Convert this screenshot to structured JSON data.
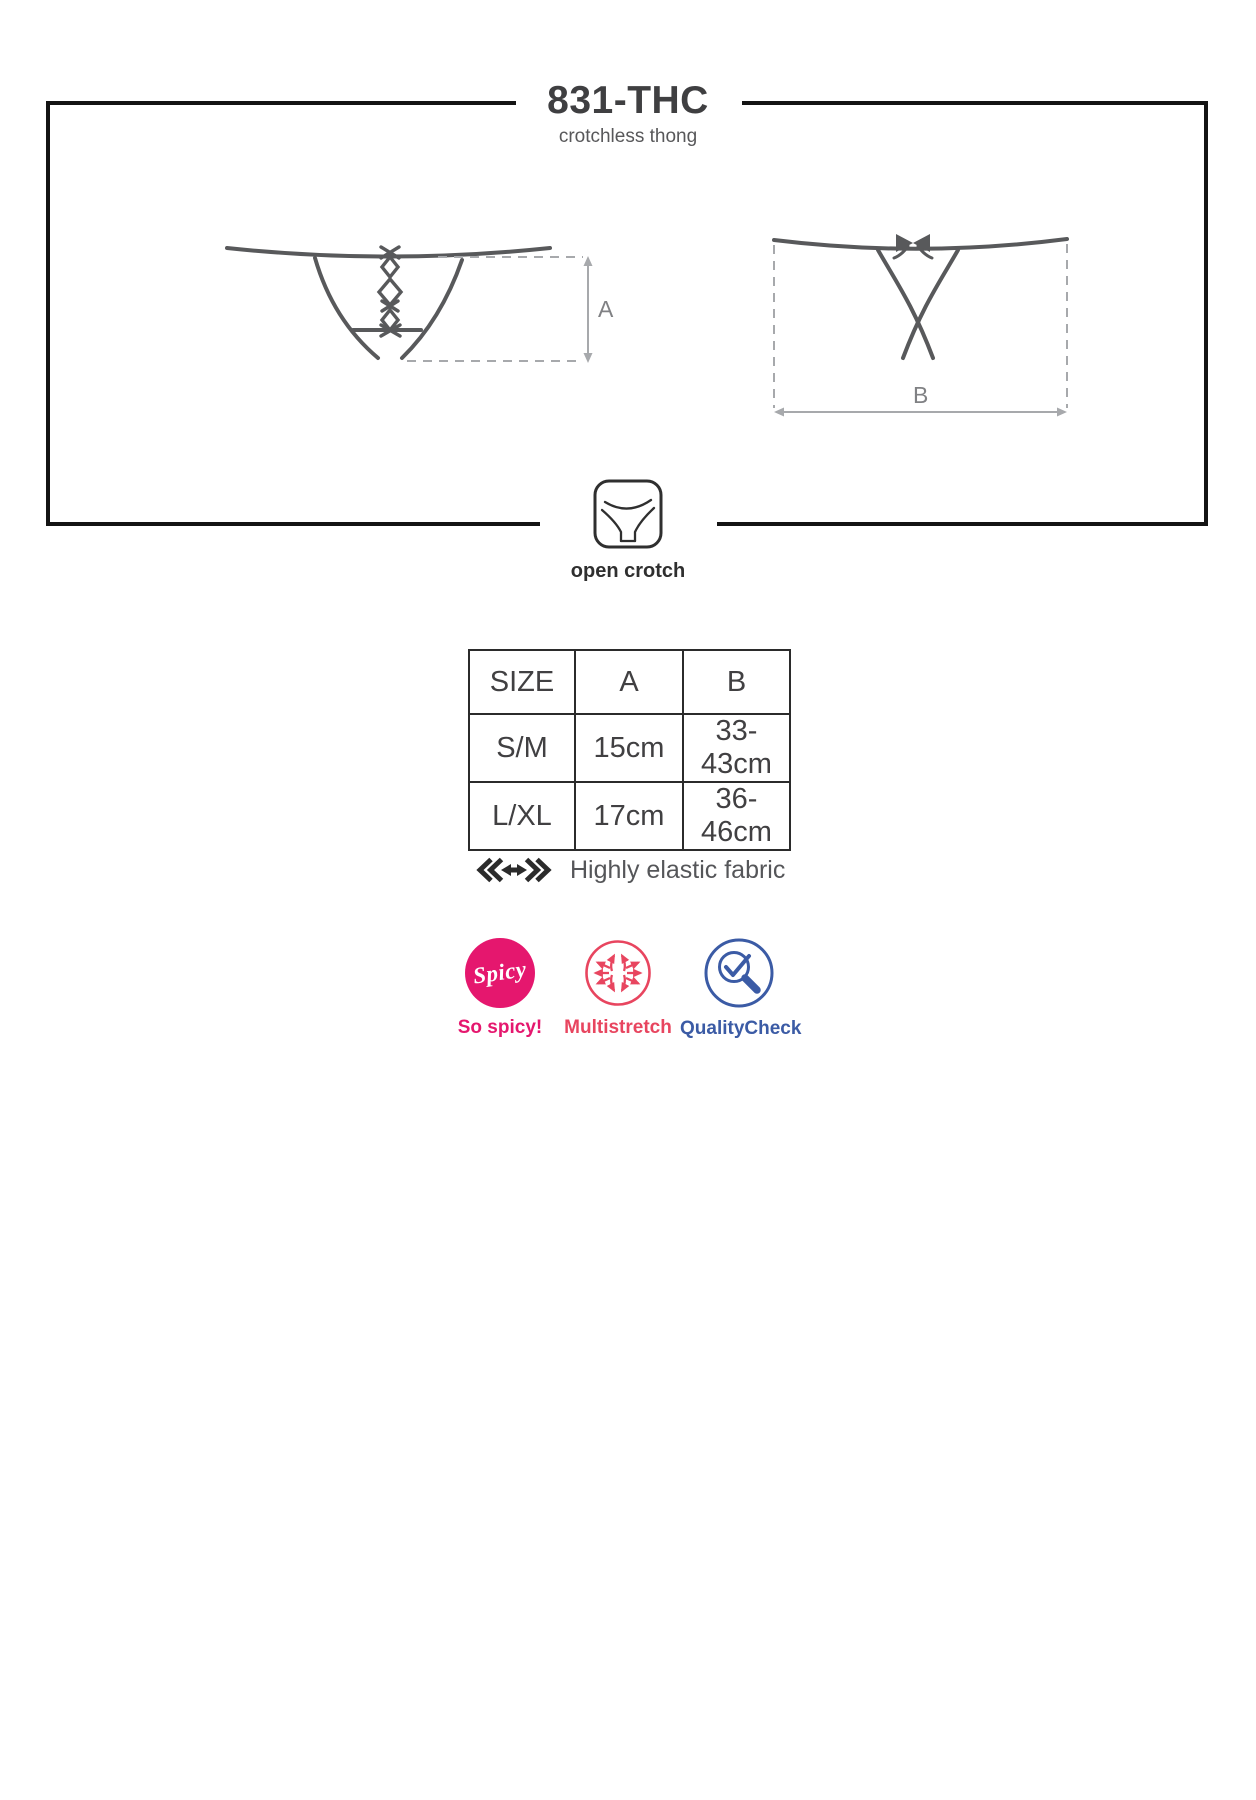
{
  "header": {
    "title": "831-THC",
    "subtitle": "crotchless thong"
  },
  "diagram": {
    "front_view": "thong-front-with-lacing",
    "back_view": "thong-back-with-bow",
    "front_label": "A",
    "back_label": "B",
    "icon_caption": "open crotch"
  },
  "size_table": {
    "headers": [
      "SIZE",
      "A",
      "B"
    ],
    "rows": [
      [
        "S/M",
        "15cm",
        "33-43cm"
      ],
      [
        "L/XL",
        "17cm",
        "36-46cm"
      ]
    ]
  },
  "fabric_note": {
    "text": "Highly elastic fabric"
  },
  "badges": [
    {
      "id": "spicy",
      "circle_text": "Spicy",
      "label": "So spicy!",
      "color": "#e5176e"
    },
    {
      "id": "multistretch",
      "label": "Multistretch",
      "color": "#e8455f"
    },
    {
      "id": "qualitycheck",
      "label": "QualityCheck",
      "color": "#3b5ba5"
    }
  ],
  "icons": [
    "open-crotch-icon",
    "elastic-stretch-icon",
    "spicy-badge-icon",
    "multistretch-arrows-icon",
    "quality-check-magnifier-icon"
  ],
  "colors": {
    "frame": "#141414",
    "drawing_line": "#58595b",
    "dimension_line": "#a7a9ac",
    "dimension_text": "#808184",
    "text_dark": "#414042",
    "pink": "#e5176e",
    "red": "#e8455f",
    "blue": "#3b5ba5"
  }
}
